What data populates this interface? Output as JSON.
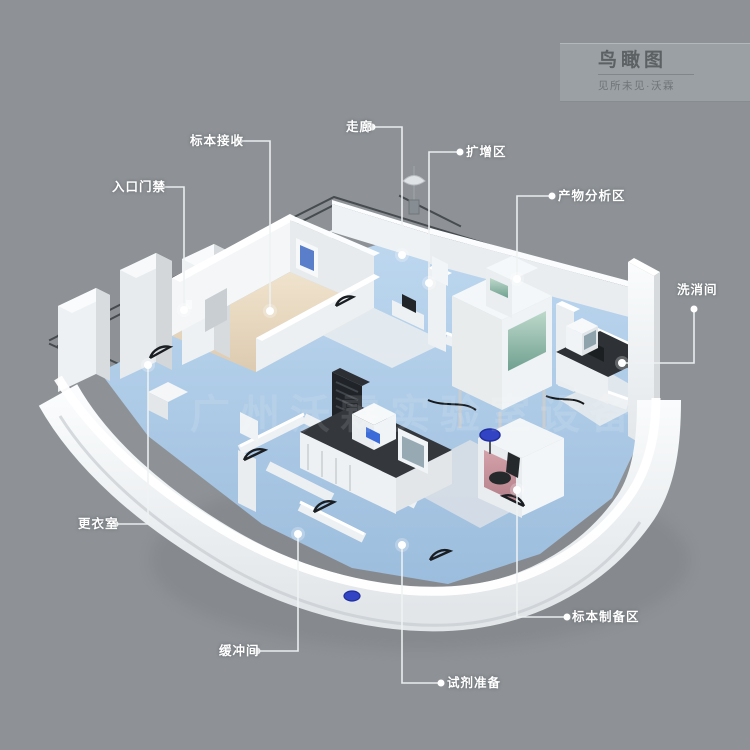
{
  "header": {
    "title": "鸟瞰图",
    "subtitle": "见所未见·沃霖"
  },
  "watermark": {
    "text": "广州沃霖实验室设备"
  },
  "callouts": [
    {
      "id": "specimen-receiving",
      "label": "标本接收"
    },
    {
      "id": "entrance-access-control",
      "label": "入口门禁"
    },
    {
      "id": "corridor",
      "label": "走廊"
    },
    {
      "id": "amplification-area",
      "label": "扩增区"
    },
    {
      "id": "product-analysis-area",
      "label": "产物分析区"
    },
    {
      "id": "washing-room",
      "label": "洗消间"
    },
    {
      "id": "changing-room",
      "label": "更衣室"
    },
    {
      "id": "buffer-room",
      "label": "缓冲间"
    },
    {
      "id": "reagent-preparation",
      "label": "试剂准备"
    },
    {
      "id": "specimen-preparation-area",
      "label": "标本制备区"
    }
  ],
  "colors": {
    "background": "#8e9296",
    "label_text": "#ffffff",
    "wall_white": "#f2f5f7",
    "floor_blue": "#a9c7e4",
    "floor_beige": "#e9dcc7",
    "cabinet_glass_green": "#8fb8a8",
    "stool_blue": "#3243c4",
    "plan_line": "#3d4247",
    "title_block_bg": "#9aa0a3",
    "title_text": "#5c6164"
  }
}
